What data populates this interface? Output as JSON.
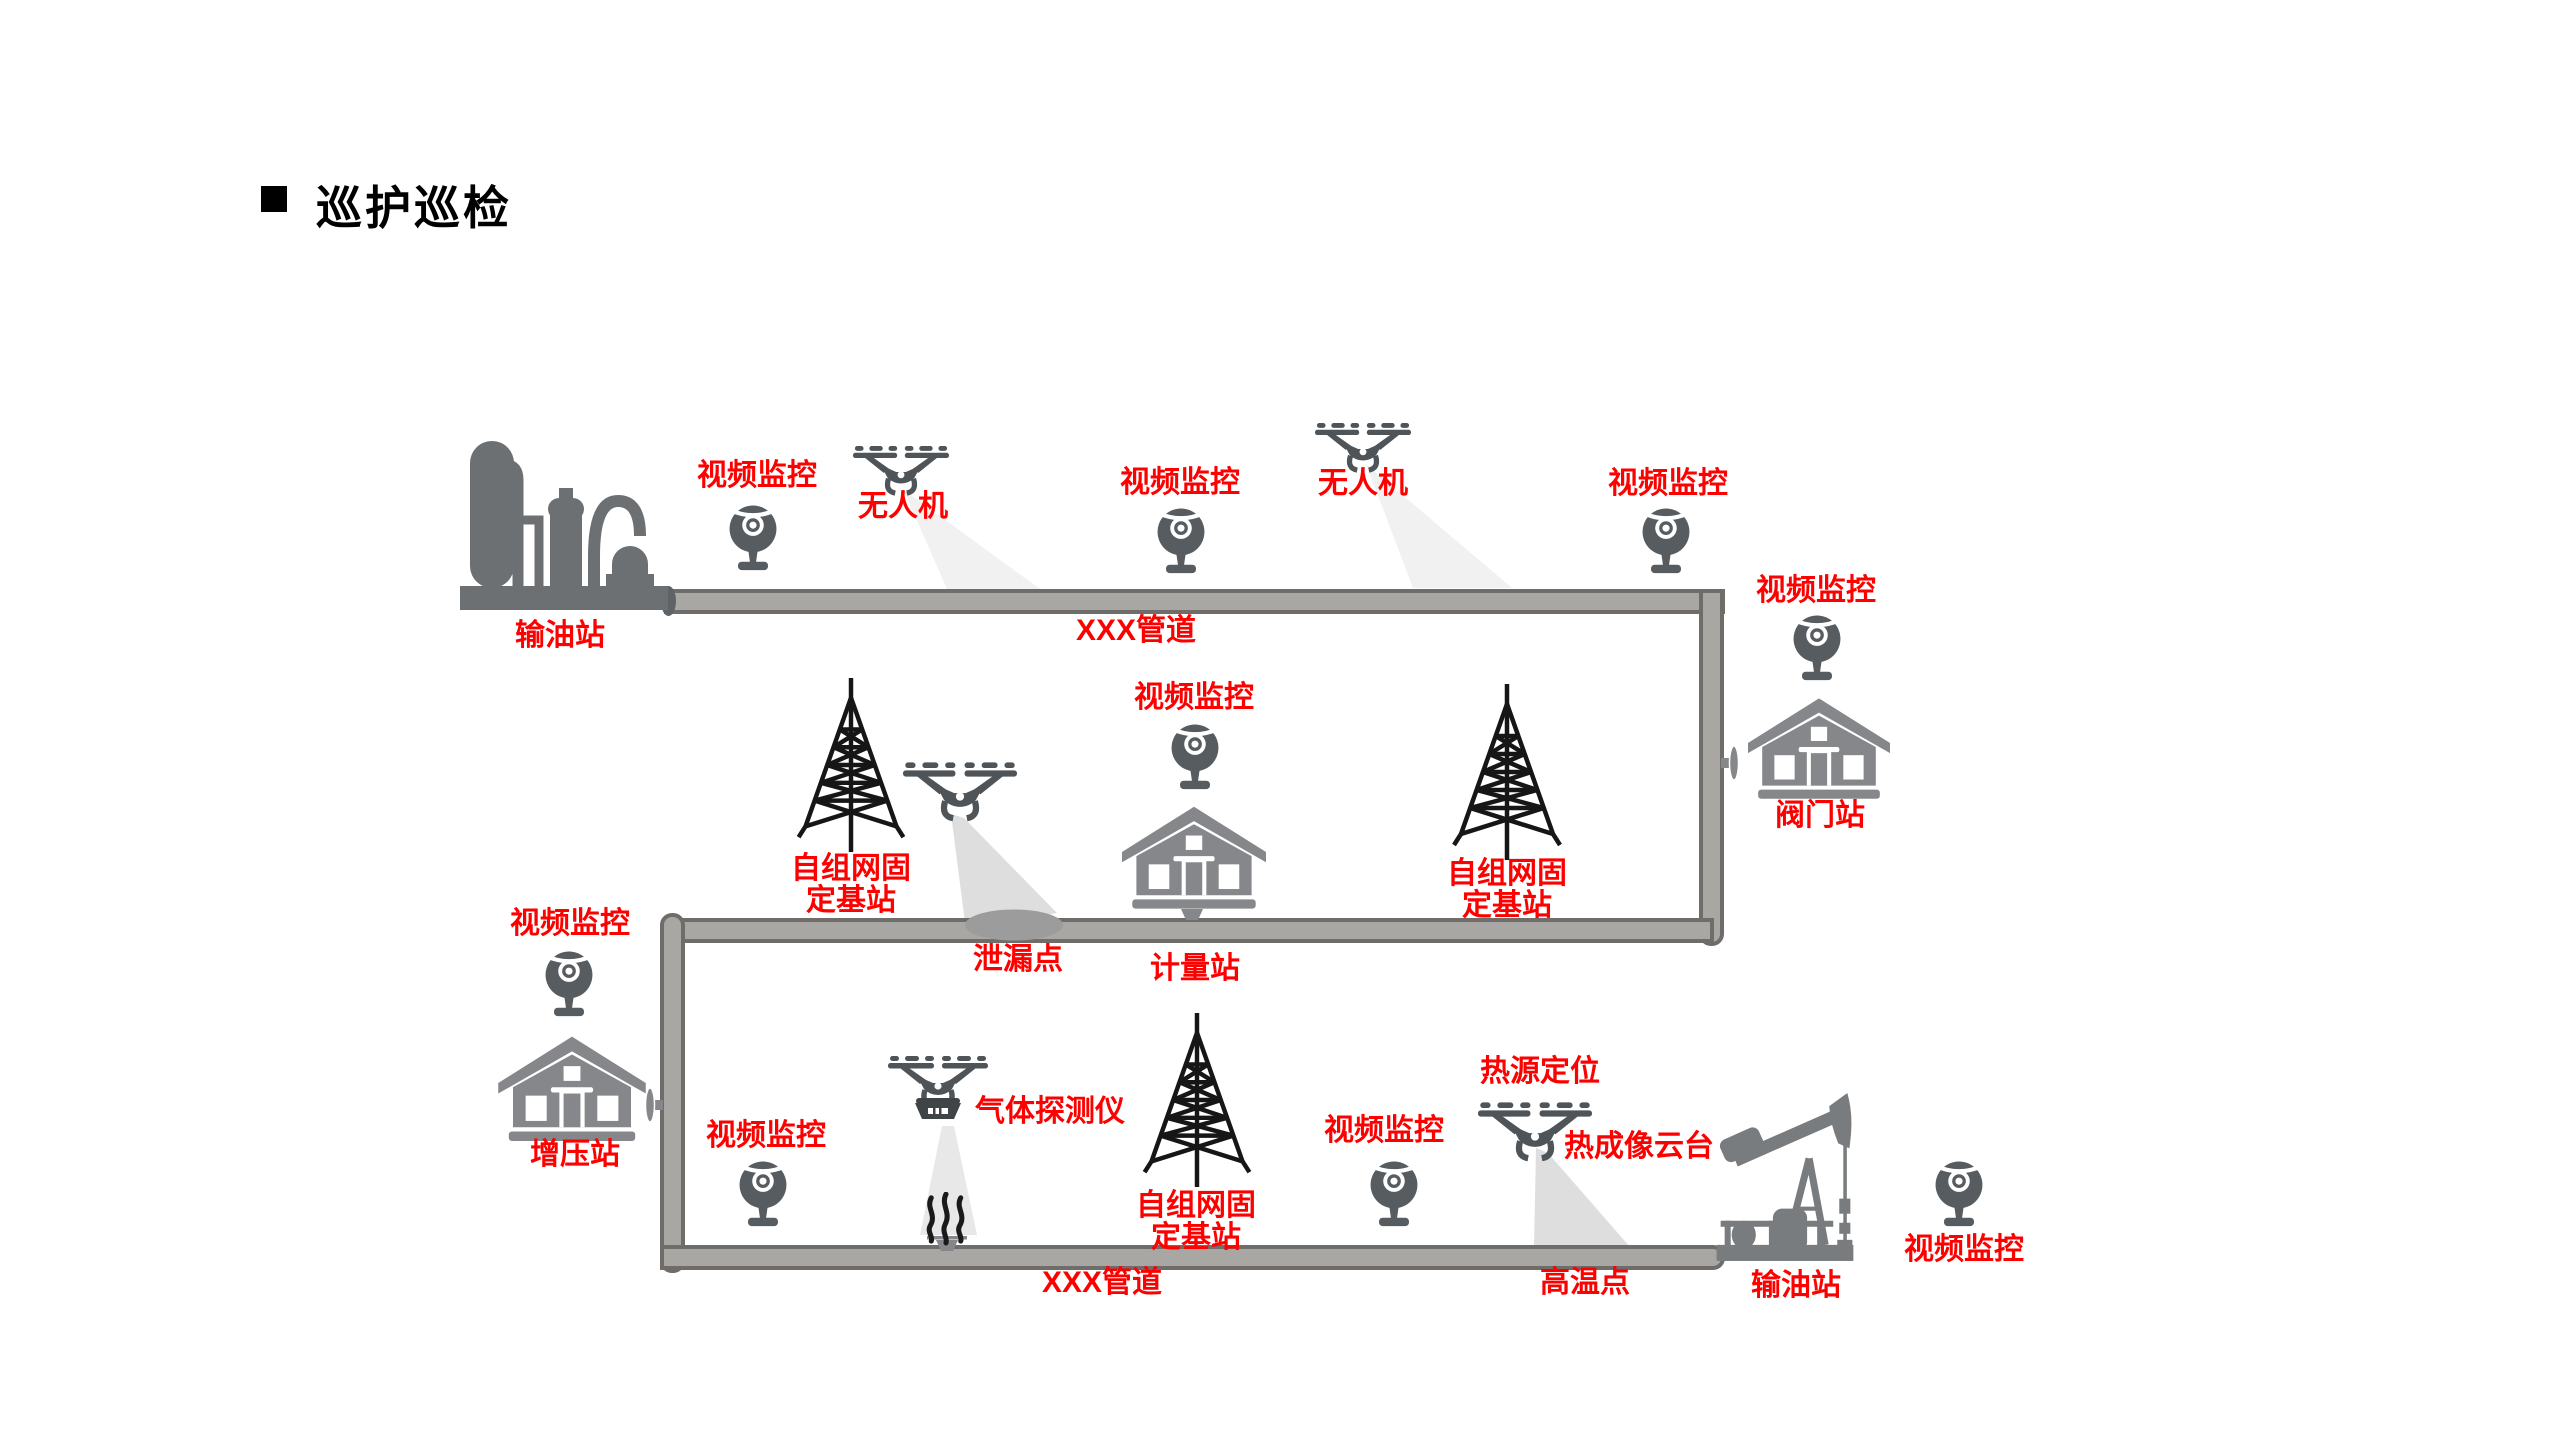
{
  "title": "巡护巡检",
  "strings": {
    "video_surveillance": "视频监控",
    "drone": "无人机",
    "pipeline": "XXX管道",
    "oil_station": "输油站",
    "adhoc_base_station": "自组网固定基站",
    "leak_point": "泄漏点",
    "metering_station": "计量站",
    "valve_station": "阀门站",
    "booster_station": "增压站",
    "gas_detector": "气体探测仪",
    "heat_source_location": "热源定位",
    "thermal_imaging_gimbal": "热成像云台",
    "high_temp_point": "高温点"
  },
  "colors": {
    "label_red": "#ff0000",
    "title_black": "#000000",
    "pipe_fill": "#a9a7a4",
    "pipe_border": "#6f6c69",
    "camera_gray": "#565c60",
    "drone_gray": "#4e5457",
    "building_gray": "#85878a",
    "refinery_gray": "#6d7073",
    "pumpjack_gray": "#797c7e",
    "tower_black": "#161616",
    "beam_light": "#f1f1f1",
    "beam_mid": "#dedede",
    "leak_gray": "#9c9c9c"
  }
}
